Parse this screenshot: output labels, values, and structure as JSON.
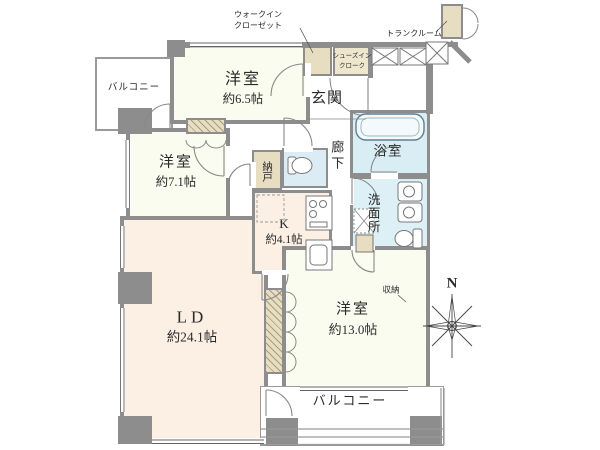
{
  "colors": {
    "wall_gray": "#8d8d8d",
    "room_ivory": "#fbfcf0",
    "room_pink": "#fcefe4",
    "closet_tan": "#e7ddc0",
    "bath_blue": "#d9edf4",
    "wash_blue": "#dcf0f6"
  },
  "rooms": {
    "balcony_left": {
      "label": "バルコニー"
    },
    "bedroom_65": {
      "label": "洋室",
      "size": "約6.5帖"
    },
    "walk_in_closet": {
      "label_line1": "ウォークイン",
      "label_line2": "クローゼット"
    },
    "shoes_in_cloak": {
      "label_line1": "シューズイン",
      "label_line2": "クローク"
    },
    "entrance": {
      "label": "玄関"
    },
    "trunk_room": {
      "label": "トランクルーム"
    },
    "corridor": {
      "label": "廊下"
    },
    "bathroom": {
      "label": "浴室"
    },
    "washroom": {
      "label": "洗面所"
    },
    "storage_nando": {
      "label": "納戸"
    },
    "kitchen": {
      "label": "K",
      "size": "約4.1帖"
    },
    "bedroom_71": {
      "label": "洋室",
      "size": "約7.1帖"
    },
    "living_dining": {
      "label": "LD",
      "size": "約24.1帖"
    },
    "bedroom_130": {
      "label": "洋室",
      "size": "約13.0帖"
    },
    "closet_shuno": {
      "label": "収納"
    },
    "balcony_bottom": {
      "label": "バルコニー"
    }
  },
  "compass": {
    "label": "N"
  }
}
